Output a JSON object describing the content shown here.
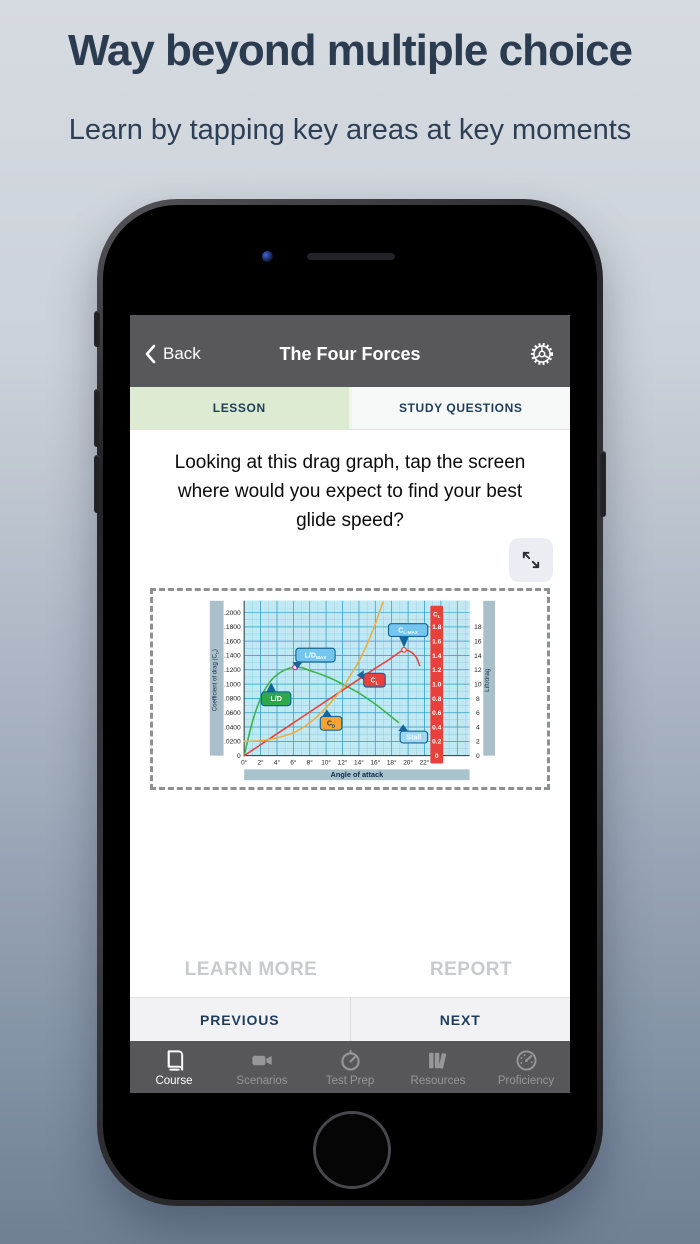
{
  "page": {
    "headline": "Way beyond multiple choice",
    "subheadline": "Learn by tapping key areas at key moments",
    "headline_color": "#2b3b50"
  },
  "app": {
    "header": {
      "back_label": "Back",
      "title": "The Four Forces",
      "bg_color": "#58585a"
    },
    "tabs": [
      {
        "label": "LESSON",
        "active": true,
        "bg_color": "#dcebd1"
      },
      {
        "label": "STUDY QUESTIONS",
        "active": false,
        "bg_color": "#f7f8f8"
      }
    ],
    "question": "Looking at this drag graph, tap the screen where would you expect to find your best glide speed?",
    "actions": {
      "learn_more": "LEARN MORE",
      "report": "REPORT",
      "previous": "PREVIOUS",
      "next": "NEXT"
    },
    "tab_bar": [
      {
        "label": "Course",
        "icon": "book-icon",
        "active": true
      },
      {
        "label": "Scenarios",
        "icon": "video-camera-icon",
        "active": false
      },
      {
        "label": "Test Prep",
        "icon": "stopwatch-icon",
        "active": false
      },
      {
        "label": "Resources",
        "icon": "library-icon",
        "active": false
      },
      {
        "label": "Proficiency",
        "icon": "gauge-icon",
        "active": false
      }
    ]
  },
  "chart_data": {
    "type": "line",
    "title": "Drag graph: coefficient of lift and drag vs angle of attack",
    "xlabel": "Angle of attack",
    "ylabel_left": "Coefficient of drag (CD)",
    "ylabel_left_parts": [
      {
        "t": "Coefficient of drag (C"
      },
      {
        "t": "D",
        "sub": true
      },
      {
        "t": ")"
      }
    ],
    "ylabel_right": "Lift/drag",
    "x_ticks_deg": [
      0,
      2,
      4,
      6,
      8,
      10,
      12,
      14,
      16,
      18,
      20,
      22
    ],
    "x_tick_suffix": "°",
    "ylim_cd": [
      0,
      0.21
    ],
    "y_left_ticks": [
      ".2000",
      ".1800",
      ".1600",
      ".1400",
      ".1200",
      ".1000",
      ".0800",
      ".0600",
      ".0400",
      ".0200",
      "0"
    ],
    "cl_bar": {
      "header": "CL",
      "header_parts": [
        {
          "t": "C"
        },
        {
          "t": "L",
          "sub": true
        }
      ],
      "values": [
        "1.8",
        "1.6",
        "1.4",
        "1.2",
        "1.0",
        "0.8",
        "0.6",
        "0.4",
        "0.2",
        "0"
      ],
      "fill": "#e8403d"
    },
    "lift_drag_ticks": [
      "18",
      "16",
      "14",
      "12",
      "10",
      "8",
      "6",
      "4",
      "2",
      "0"
    ],
    "grid": true,
    "series": [
      {
        "name": "L/D",
        "axis": "cd",
        "color": "#3cb24b",
        "points": [
          [
            0,
            0
          ],
          [
            1,
            0.047
          ],
          [
            2,
            0.08
          ],
          [
            3,
            0.101
          ],
          [
            4,
            0.113
          ],
          [
            5,
            0.12
          ],
          [
            6,
            0.1235
          ],
          [
            7,
            0.123
          ],
          [
            8,
            0.119
          ],
          [
            10,
            0.111
          ],
          [
            12,
            0.1
          ],
          [
            14,
            0.0875
          ],
          [
            16,
            0.072
          ],
          [
            17,
            0.063
          ],
          [
            18,
            0.054
          ],
          [
            18.8,
            0.0465
          ]
        ]
      },
      {
        "name": "CL",
        "axis": "cl",
        "color": "#e8403d",
        "points": [
          [
            0,
            0
          ],
          [
            2,
            0.152
          ],
          [
            4,
            0.305
          ],
          [
            6,
            0.457
          ],
          [
            8,
            0.61
          ],
          [
            10,
            0.762
          ],
          [
            12,
            0.915
          ],
          [
            14,
            1.067
          ],
          [
            16,
            1.22
          ],
          [
            17.5,
            1.33
          ],
          [
            18.5,
            1.408
          ],
          [
            19.5,
            1.478
          ],
          [
            20.3,
            1.452
          ],
          [
            21,
            1.375
          ],
          [
            21.4,
            1.26
          ]
        ]
      },
      {
        "name": "CD",
        "axis": "cd",
        "color": "#efae3e",
        "points": [
          [
            0,
            0.02
          ],
          [
            2,
            0.0208
          ],
          [
            4,
            0.025
          ],
          [
            6,
            0.032
          ],
          [
            8,
            0.046
          ],
          [
            10,
            0.067
          ],
          [
            12,
            0.0945
          ],
          [
            13,
            0.113
          ],
          [
            14,
            0.132
          ],
          [
            15,
            0.156
          ],
          [
            16,
            0.184
          ],
          [
            16.9,
            0.214
          ]
        ]
      }
    ],
    "markers": [
      {
        "x": 6.2,
        "y": 0.1235,
        "axis": "cd",
        "stroke": "#c03a9e",
        "meaning": "L/D max point"
      },
      {
        "x": 19.5,
        "y": 1.478,
        "axis": "cl",
        "stroke": "#e8403d",
        "meaning": "CL max point"
      }
    ],
    "callouts": [
      {
        "name": "ld-label",
        "parts": [
          {
            "t": "L/D"
          }
        ],
        "fill": "#2fa84c",
        "stroke": "#14669a",
        "text": "#ffffff",
        "x": 3.9,
        "y": 0.0795,
        "w": 30,
        "h": 14,
        "tx": 3.3,
        "ty": 0.102
      },
      {
        "name": "ld-max-label",
        "parts": [
          {
            "t": "L/D"
          },
          {
            "t": "MAX",
            "sub": true
          }
        ],
        "fill": "#74c6ee",
        "stroke": "#14669a",
        "text": "#ffffff",
        "x": 8.7,
        "y": 0.1405,
        "w": 40,
        "h": 14,
        "tx": 6.5,
        "ty": 0.127
      },
      {
        "name": "cl-max-label",
        "parts": [
          {
            "t": "C"
          },
          {
            "t": "L-MAX",
            "sub": true
          }
        ],
        "fill": "#74c6ee",
        "stroke": "#14669a",
        "text": "#ffffff",
        "x": 20.0,
        "y": 0.1755,
        "w": 40,
        "h": 13,
        "tx": 19.5,
        "ty": 0.151
      },
      {
        "name": "cl-label",
        "parts": [
          {
            "t": "C"
          },
          {
            "t": "L",
            "sub": true
          }
        ],
        "fill": "#e8403d",
        "stroke": "#14669a",
        "text": "#ffffff",
        "x": 15.9,
        "y": 0.1055,
        "w": 22,
        "h": 14,
        "tx": 14.3,
        "ty": 0.1125
      },
      {
        "name": "cd-label",
        "parts": [
          {
            "t": "C"
          },
          {
            "t": "D",
            "sub": true
          }
        ],
        "fill": "#f5a431",
        "stroke": "#14669a",
        "text": "#1b3a5c",
        "x": 10.6,
        "y": 0.0452,
        "w": 22,
        "h": 14,
        "tx": 10.1,
        "ty": 0.0625
      },
      {
        "name": "stall-label",
        "parts": [
          {
            "t": "Stall"
          }
        ],
        "fill": "#9fd8f2",
        "stroke": "#14669a",
        "text": "#f2faff",
        "x": 20.7,
        "y": 0.026,
        "w": 28,
        "h": 12,
        "tx": 19.4,
        "ty": 0.0415
      }
    ]
  }
}
